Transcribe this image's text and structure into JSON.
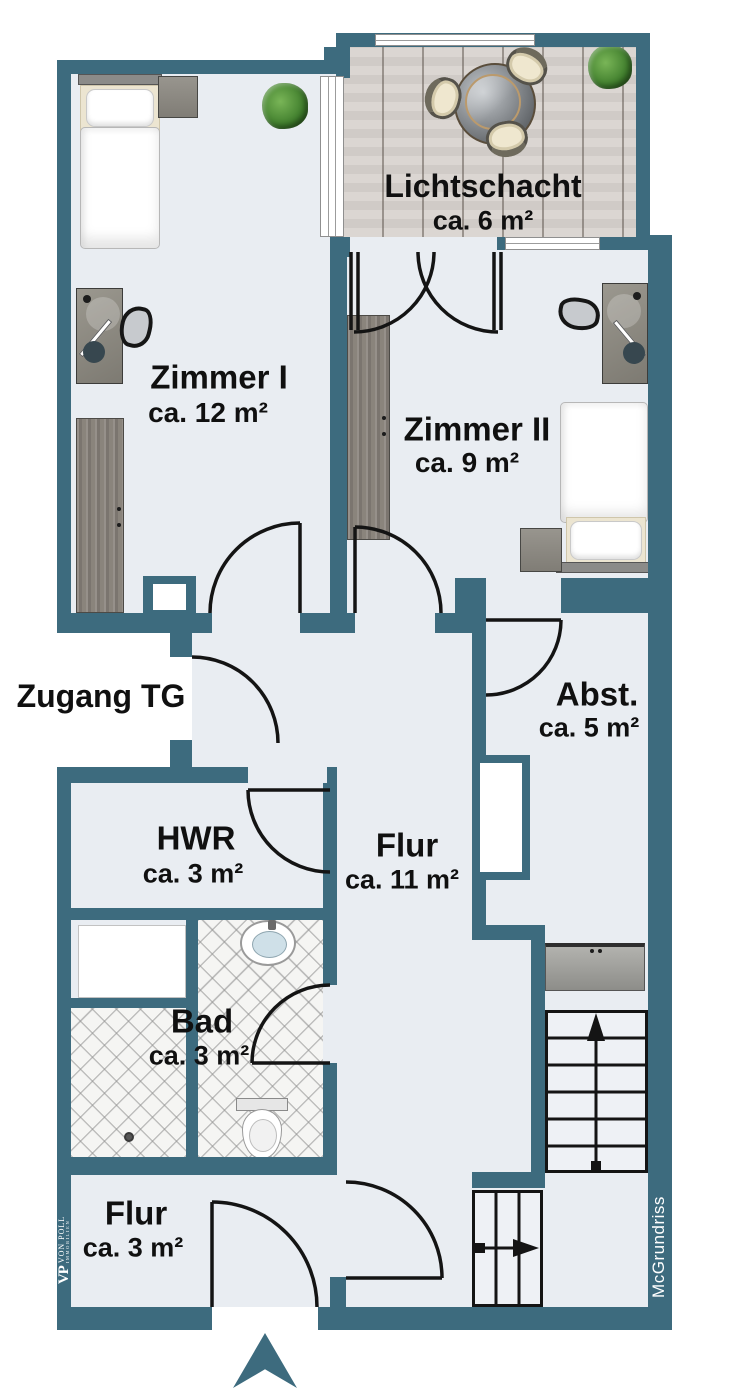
{
  "colors": {
    "wall": "#3d6b7e",
    "floor": "#e9edf2",
    "deck": "#d8d3cf",
    "line": "#141414"
  },
  "rooms": [
    {
      "key": "lichtschacht",
      "name": "Lichtschacht",
      "area": "ca. 6 m²"
    },
    {
      "key": "zimmer-1",
      "name": "Zimmer I",
      "area": "ca. 12 m²"
    },
    {
      "key": "zimmer-2",
      "name": "Zimmer II",
      "area": "ca. 9 m²"
    },
    {
      "key": "abstellraum",
      "name": "Abst.",
      "area": "ca. 5 m²"
    },
    {
      "key": "hwr",
      "name": "HWR",
      "area": "ca. 3 m²"
    },
    {
      "key": "flur",
      "name": "Flur",
      "area": "ca. 11 m²"
    },
    {
      "key": "bad",
      "name": "Bad",
      "area": "ca. 3 m²"
    },
    {
      "key": "flur-unten",
      "name": "Flur",
      "area": "ca. 3 m²"
    }
  ],
  "labels": {
    "access": "Zugang TG"
  },
  "branding": {
    "logo_monogram": "VP",
    "logo_name": "VON POLL",
    "logo_sub": "IMMOBILIEN",
    "watermark": "McGrundriss"
  }
}
